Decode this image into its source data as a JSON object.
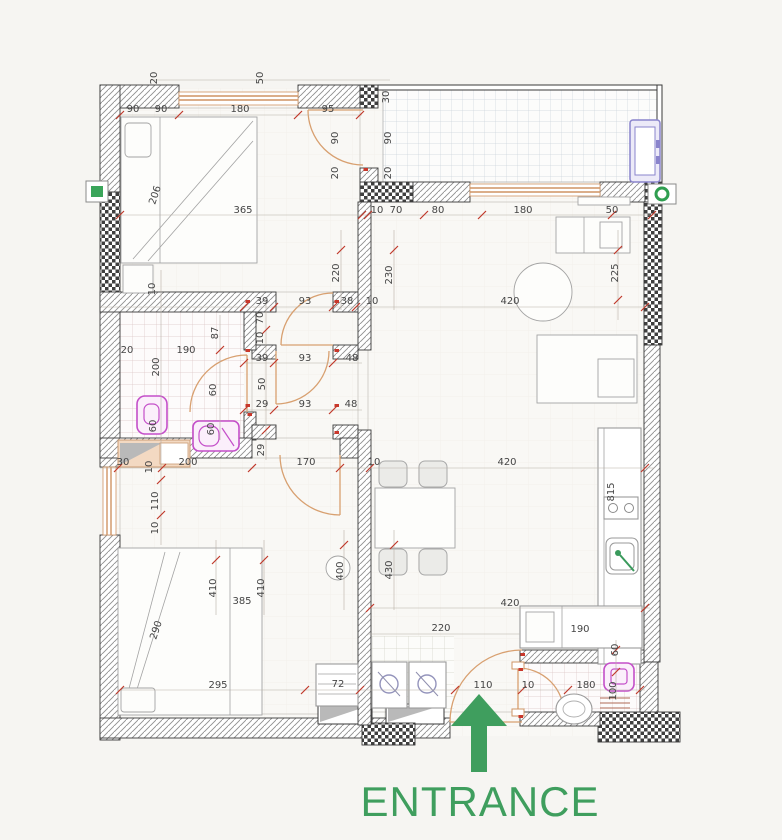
{
  "plan": {
    "entrance_label": "ENTRANCE",
    "dimensions": [
      {
        "t": "20",
        "x": 157,
        "y": 78,
        "r": -90
      },
      {
        "t": "50",
        "x": 263,
        "y": 78,
        "r": -90
      },
      {
        "t": "30",
        "x": 389,
        "y": 97,
        "r": -90
      },
      {
        "t": "90",
        "x": 133,
        "y": 112
      },
      {
        "t": "90",
        "x": 161,
        "y": 112
      },
      {
        "t": "180",
        "x": 240,
        "y": 112
      },
      {
        "t": "95",
        "x": 328,
        "y": 112
      },
      {
        "t": "90",
        "x": 338,
        "y": 138,
        "r": -90
      },
      {
        "t": "90",
        "x": 391,
        "y": 138,
        "r": -90
      },
      {
        "t": "20",
        "x": 338,
        "y": 173,
        "r": -90
      },
      {
        "t": "20",
        "x": 391,
        "y": 173,
        "r": -90
      },
      {
        "t": "10",
        "x": 377,
        "y": 213
      },
      {
        "t": "70",
        "x": 396,
        "y": 213
      },
      {
        "t": "80",
        "x": 438,
        "y": 213
      },
      {
        "t": "180",
        "x": 523,
        "y": 213
      },
      {
        "t": "50",
        "x": 612,
        "y": 213
      },
      {
        "t": "365",
        "x": 243,
        "y": 213
      },
      {
        "t": "206",
        "x": 158,
        "y": 196,
        "r": -72
      },
      {
        "t": "10",
        "x": 155,
        "y": 289,
        "r": -90
      },
      {
        "t": "39",
        "x": 262,
        "y": 304
      },
      {
        "t": "93",
        "x": 305,
        "y": 304
      },
      {
        "t": "38",
        "x": 347,
        "y": 304
      },
      {
        "t": "10",
        "x": 372,
        "y": 304
      },
      {
        "t": "420",
        "x": 510,
        "y": 304
      },
      {
        "t": "220",
        "x": 339,
        "y": 273,
        "r": -90
      },
      {
        "t": "230",
        "x": 392,
        "y": 275,
        "r": -90
      },
      {
        "t": "225",
        "x": 618,
        "y": 273,
        "r": -90
      },
      {
        "t": "87",
        "x": 218,
        "y": 333,
        "r": -90
      },
      {
        "t": "190",
        "x": 186,
        "y": 353
      },
      {
        "t": "20",
        "x": 127,
        "y": 353
      },
      {
        "t": "200",
        "x": 159,
        "y": 367,
        "r": -90
      },
      {
        "t": "70",
        "x": 263,
        "y": 318,
        "r": -90
      },
      {
        "t": "10",
        "x": 263,
        "y": 338,
        "r": -90
      },
      {
        "t": "39",
        "x": 262,
        "y": 361
      },
      {
        "t": "93",
        "x": 305,
        "y": 361
      },
      {
        "t": "48",
        "x": 352,
        "y": 361
      },
      {
        "t": "60",
        "x": 216,
        "y": 390,
        "r": -90
      },
      {
        "t": "50",
        "x": 265,
        "y": 384,
        "r": -90
      },
      {
        "t": "29",
        "x": 262,
        "y": 407
      },
      {
        "t": "93",
        "x": 305,
        "y": 407
      },
      {
        "t": "48",
        "x": 351,
        "y": 407
      },
      {
        "t": "60",
        "x": 156,
        "y": 426,
        "r": -90
      },
      {
        "t": "60",
        "x": 214,
        "y": 429,
        "r": -90
      },
      {
        "t": "29",
        "x": 264,
        "y": 450,
        "r": -90
      },
      {
        "t": "30",
        "x": 123,
        "y": 465
      },
      {
        "t": "10",
        "x": 152,
        "y": 467,
        "r": -90
      },
      {
        "t": "200",
        "x": 188,
        "y": 465
      },
      {
        "t": "170",
        "x": 306,
        "y": 465
      },
      {
        "t": "10",
        "x": 374,
        "y": 465
      },
      {
        "t": "420",
        "x": 507,
        "y": 465
      },
      {
        "t": "110",
        "x": 158,
        "y": 501,
        "r": -90
      },
      {
        "t": "10",
        "x": 158,
        "y": 528,
        "r": -90
      },
      {
        "t": "410",
        "x": 216,
        "y": 588,
        "r": -90
      },
      {
        "t": "410",
        "x": 264,
        "y": 588,
        "r": -90
      },
      {
        "t": "400",
        "x": 343,
        "y": 571,
        "r": -90
      },
      {
        "t": "430",
        "x": 392,
        "y": 570,
        "r": -90
      },
      {
        "t": "385",
        "x": 242,
        "y": 604
      },
      {
        "t": "290",
        "x": 159,
        "y": 631,
        "r": -72
      },
      {
        "t": "815",
        "x": 614,
        "y": 492,
        "r": -90
      },
      {
        "t": "420",
        "x": 510,
        "y": 606
      },
      {
        "t": "190",
        "x": 580,
        "y": 632
      },
      {
        "t": "220",
        "x": 441,
        "y": 631
      },
      {
        "t": "295",
        "x": 218,
        "y": 688
      },
      {
        "t": "72",
        "x": 338,
        "y": 687
      },
      {
        "t": "110",
        "x": 483,
        "y": 688
      },
      {
        "t": "10",
        "x": 528,
        "y": 688
      },
      {
        "t": "180",
        "x": 586,
        "y": 688
      },
      {
        "t": "60",
        "x": 618,
        "y": 650,
        "r": -90
      },
      {
        "t": "100",
        "x": 616,
        "y": 691,
        "r": -90
      }
    ]
  },
  "colors": {
    "background": "#f6f5f2",
    "wall_line": "#3a3a3a",
    "window_orange": "#cf9464",
    "door_arc": "#d8a070",
    "fixture_magenta": "#c44fc9",
    "marker_red": "#c0392b",
    "accent_green": "#3f9e5e",
    "ac_unit_purple": "#8a84cc"
  },
  "icons": {
    "entrance-arrow": "green up arrow",
    "green-wall-marker-left": "green square in box",
    "green-wall-marker-right": "green ring in box",
    "door-hinge-marker": "small red door jamb symbol",
    "ac-unit": "purple rectangle on balcony",
    "sink-faucet-dot": "green dot"
  }
}
